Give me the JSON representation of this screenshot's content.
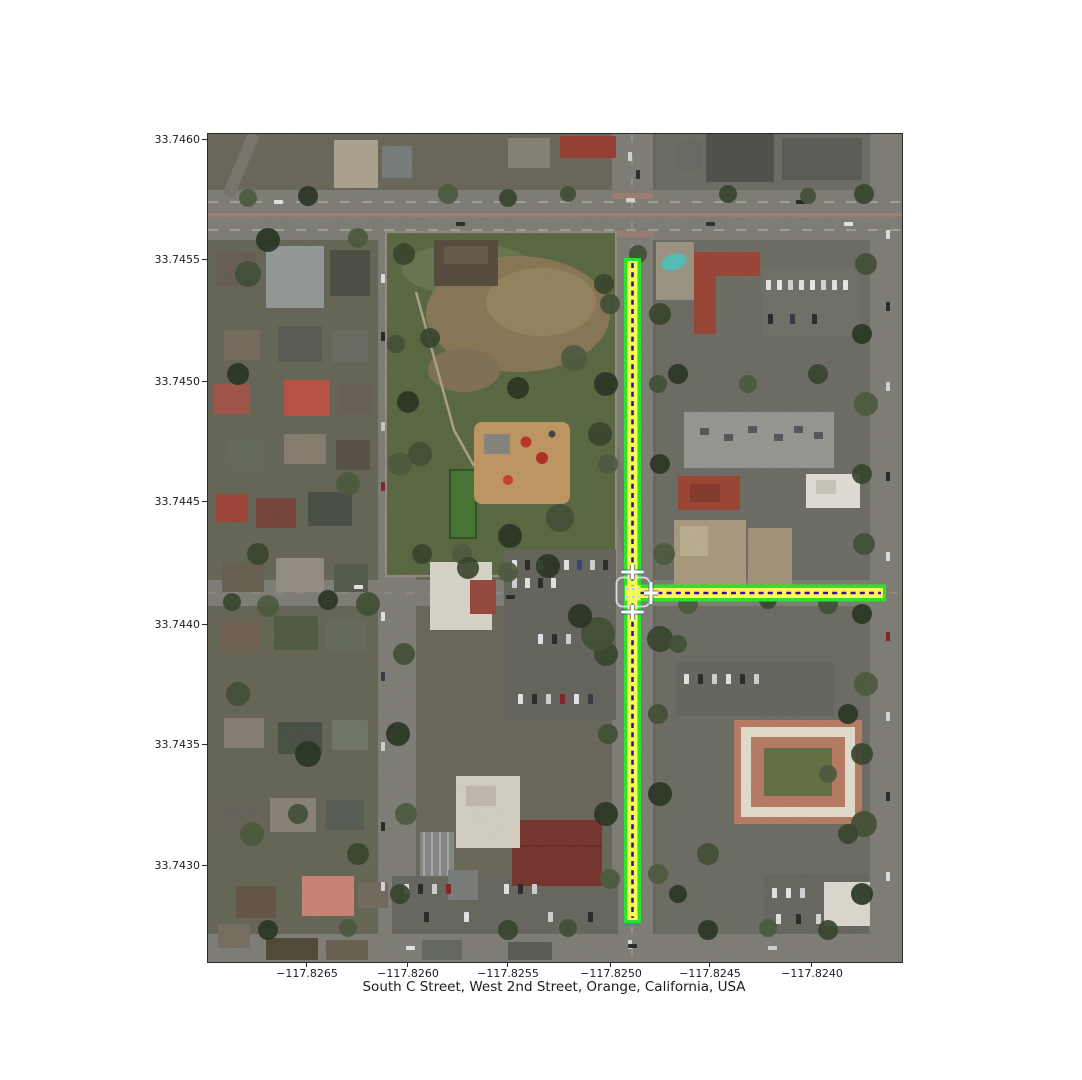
{
  "map": {
    "caption": "South C Street, West 2nd Street, Orange, California, USA",
    "imagery": "aerial-satellite-photo",
    "place": {
      "city": "Orange",
      "state": "California",
      "country": "USA"
    },
    "highlighted_streets": [
      "South C Street",
      "West 2nd Street"
    ],
    "axes": {
      "y_axis_meaning": "latitude",
      "x_axis_meaning": "longitude",
      "y_ticks": [
        "33.7460",
        "33.7455",
        "33.7450",
        "33.7445",
        "33.7440",
        "33.7435",
        "33.7430"
      ],
      "x_ticks": [
        "−117.8265",
        "−117.8260",
        "−117.8255",
        "−117.8250",
        "−117.8245",
        "−117.8240"
      ]
    },
    "route_overlay": {
      "edge_color": "#2ce32c",
      "fill_color": "#fbfa52",
      "centerline_color": "#1d1da0",
      "centerline_style": "dashed",
      "marker_color": "#ffffff",
      "intersection_box_color": "#e9eaf8"
    }
  },
  "chart_data": {
    "type": "map",
    "title": "South C Street, West 2nd Street, Orange, California, USA",
    "basemap": "satellite aerial imagery",
    "x_axis": {
      "label": "longitude",
      "ticks": [
        -117.8265,
        -117.826,
        -117.8255,
        -117.825,
        -117.8245,
        -117.824
      ],
      "range": [
        -117.827,
        -117.8236
      ]
    },
    "y_axis": {
      "label": "latitude",
      "ticks": [
        33.746,
        33.7455,
        33.745,
        33.7445,
        33.744,
        33.7435,
        33.743
      ],
      "range": [
        33.7426,
        33.746
      ]
    },
    "grid": false,
    "legend": false,
    "highlighted_route": {
      "intersection": {
        "lon": -117.8249,
        "lat": 33.74413
      },
      "segments": [
        {
          "name": "South C Street",
          "orientation": "north-south",
          "from": {
            "lon": -117.8249,
            "lat": 33.74551
          },
          "to": {
            "lon": -117.8249,
            "lat": 33.74277
          }
        },
        {
          "name": "West 2nd Street",
          "orientation": "east-west",
          "from": {
            "lon": -117.8249,
            "lat": 33.74413
          },
          "to": {
            "lon": -117.82364,
            "lat": 33.74413
          }
        }
      ]
    }
  }
}
